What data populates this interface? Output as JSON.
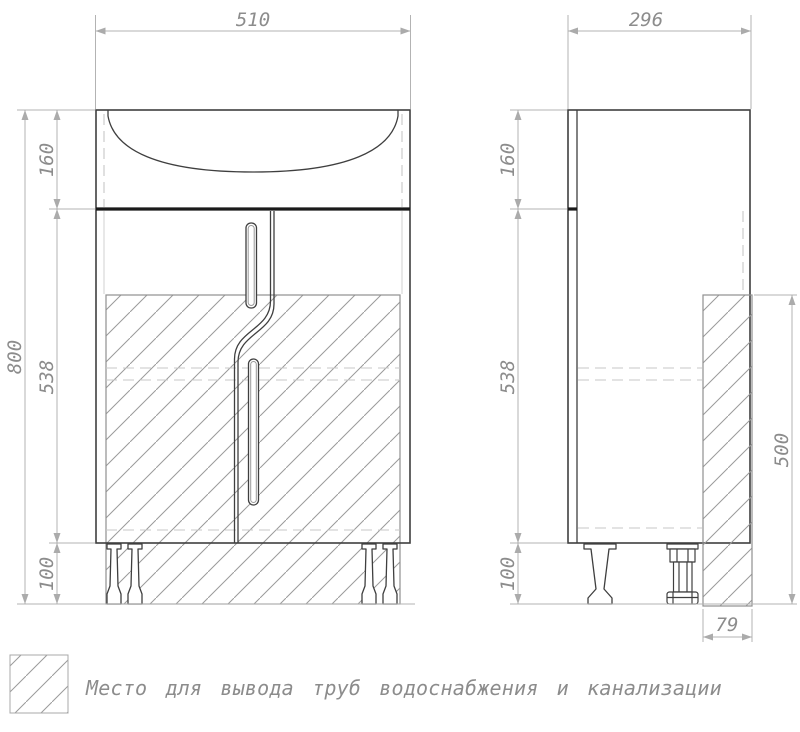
{
  "drawing": {
    "front": {
      "width": "510",
      "total_height": "800",
      "top_section": "160",
      "body_section": "538",
      "leg_section": "100"
    },
    "side": {
      "depth": "296",
      "top_section": "160",
      "body_section": "538",
      "leg_section": "100",
      "pipe_zone_height": "500",
      "pipe_zone_width": "79"
    },
    "legend": {
      "text": "Место для вывода труб водоснабжения и канализации"
    },
    "colors": {
      "outline": "#3f3f3f",
      "dark": "#1a1a1a",
      "dim": "#b3b3b3",
      "label": "#8c8c8c",
      "hatch": "#9a9a9a",
      "hidden": "#c7c7c7",
      "background": "#ffffff"
    }
  }
}
